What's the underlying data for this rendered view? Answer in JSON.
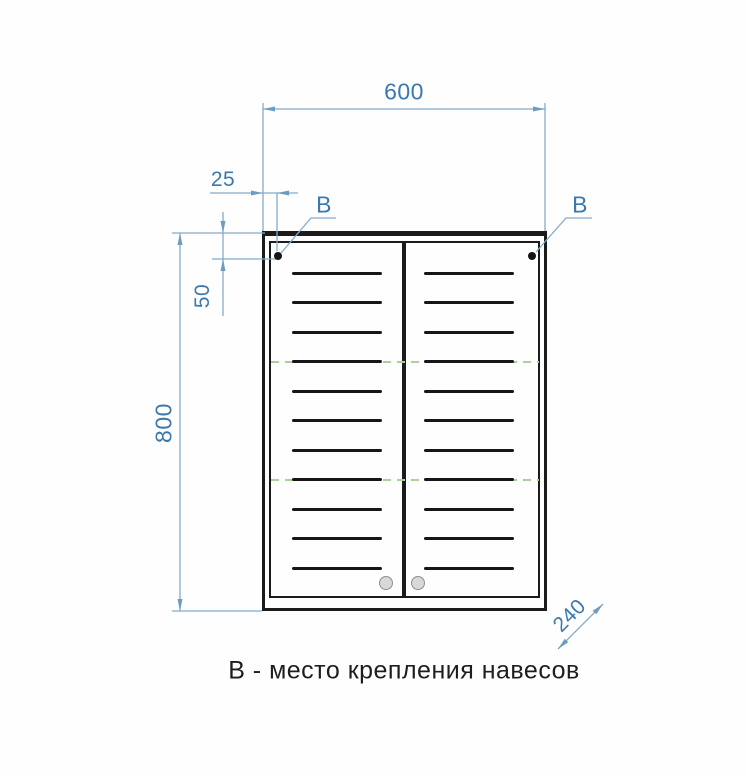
{
  "drawing": {
    "caption": "В - место крепления навесов",
    "dimensions": {
      "width_mm": "600",
      "height_mm": "800",
      "depth_mm": "240",
      "hanger_offset_x_mm": "25",
      "hanger_offset_y_mm": "50"
    },
    "labels": {
      "hanger_left": "В",
      "hanger_right": "В"
    },
    "cabinet": {
      "door_count": 2,
      "slats_per_door": 11,
      "shelf_rows": [
        3,
        7
      ],
      "handle_count": 2,
      "mount_point_count": 2
    },
    "colors": {
      "dimension_text": "#3a78ae",
      "dimension_line": "#85abca",
      "drawing_line": "#1b1b1b",
      "shelf_dashed": "#a8cf9c",
      "handle_fill": "#d8d8d8"
    }
  }
}
